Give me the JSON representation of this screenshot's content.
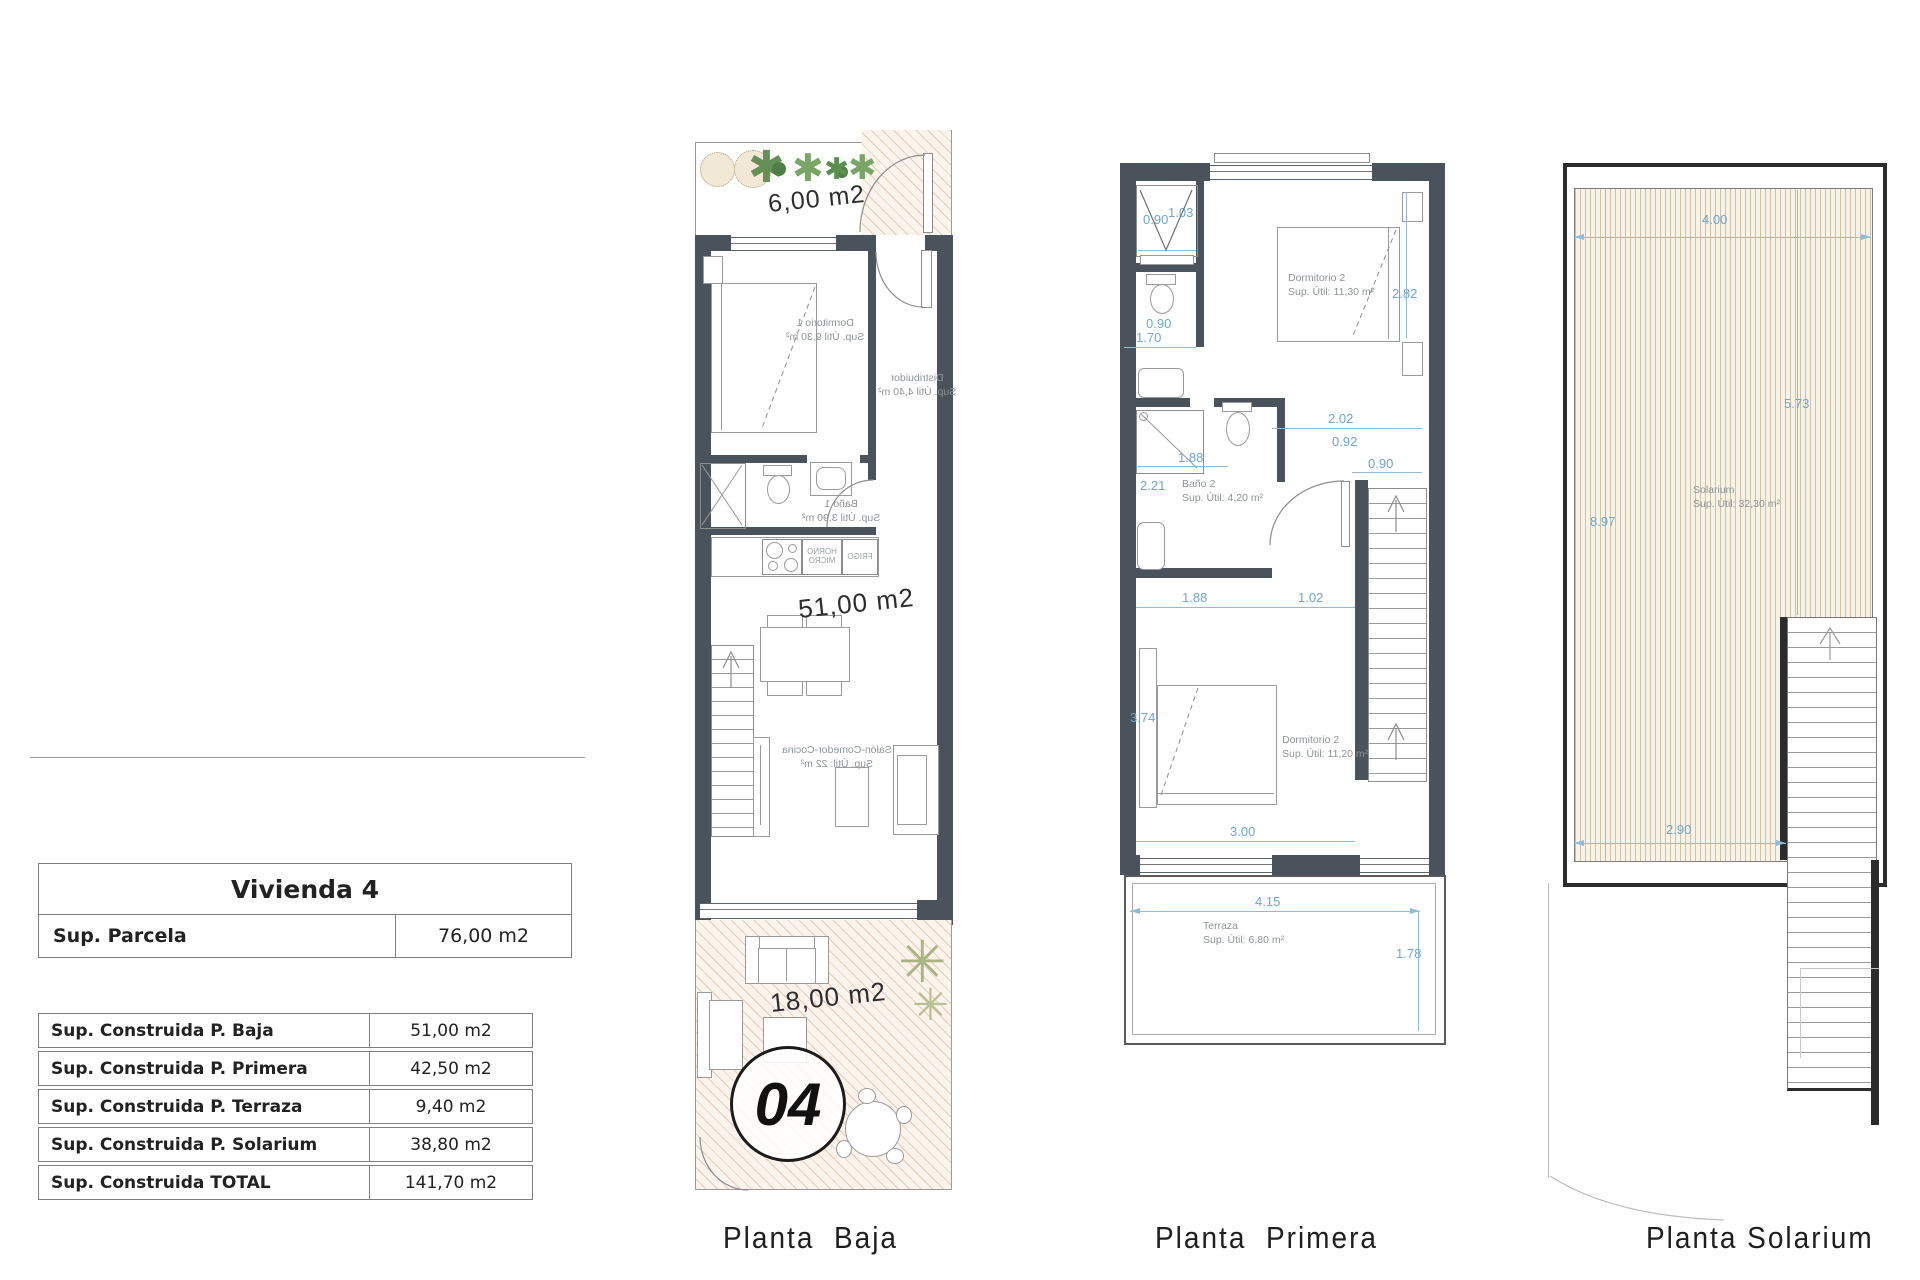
{
  "summary_table": {
    "title": "Vivienda 4",
    "parcela_label": "Sup. Parcela",
    "parcela_value": "76,00 m2",
    "rows": [
      {
        "label": "Sup. Construida P. Baja",
        "value": "51,00 m2"
      },
      {
        "label": "Sup. Construida P. Primera",
        "value": "42,50 m2"
      },
      {
        "label": "Sup. Construida P. Terraza",
        "value": "9,40 m2"
      },
      {
        "label": "Sup. Construida P. Solarium",
        "value": "38,80 m2"
      },
      {
        "label": "Sup. Construida TOTAL",
        "value": "141,70 m2"
      }
    ]
  },
  "captions": {
    "baja": "Planta  Baja",
    "primera": "Planta  Primera",
    "solarium": "Planta Solarium"
  },
  "planta_baja": {
    "garden_area": "6,00 m2",
    "floor_area": "51,00 m2",
    "terrace_area": "18,00 m2",
    "unit_number": "04",
    "rooms": {
      "dormitorio1": {
        "name": "Dormitorio 1",
        "area": "Sup. Útil 9,30 m²"
      },
      "distribuidor": {
        "name": "Distribuidor",
        "area": "Sup. Útil 4,40 m²"
      },
      "bano1": {
        "name": "Baño 1",
        "area": "Sup. Útil 3,90 m²"
      },
      "salon": {
        "name": "Salón-Comedor-Cocina",
        "area": "Sup. Útil: 22 m²"
      }
    },
    "kitchen": {
      "horno": "HORNO MICRO",
      "frigo": "FRIGO"
    }
  },
  "planta_primera": {
    "rooms": {
      "dormitorio2": {
        "name": "Dormitorio 2",
        "area": "Sup. Útil: 11,30 m²"
      },
      "bano2": {
        "name": "Baño 2",
        "area": "Sup. Útil: 4,20 m²"
      },
      "dormitorio2b": {
        "name": "Dormitorio 2",
        "area": "Sup. Útil: 11,20 m²"
      },
      "terraza": {
        "name": "Terraza",
        "area": "Sup. Útil: 6,80 m²"
      }
    },
    "dims": {
      "closet_w": "0.90",
      "closet_d": "1.03",
      "wc_w": "0.90",
      "wc_total": "1.70",
      "bed_h": "2.82",
      "shower_w": "1.88",
      "bano_h": "2.21",
      "hall_a": "2.02",
      "hall_b": "0.92",
      "stair_w": "0.90",
      "bed2_a": "1.88",
      "bed2_b": "1.02",
      "bed2_h": "3.74",
      "bed2_w": "3.00",
      "terr_w": "4.15",
      "terr_h": "1.78"
    }
  },
  "planta_solarium": {
    "room": {
      "name": "Solarium",
      "area": "Sup. Útil: 32,30 m²"
    },
    "dims": {
      "top": "4.00",
      "right": "5.73",
      "left": "8.97",
      "bottom": "2.90"
    }
  },
  "colors": {
    "wall": "#4a525b",
    "dimension_blue": "#6fa6c9",
    "hatch_tan": "#ca9173",
    "deck_stripe": "#cfc1a8"
  }
}
